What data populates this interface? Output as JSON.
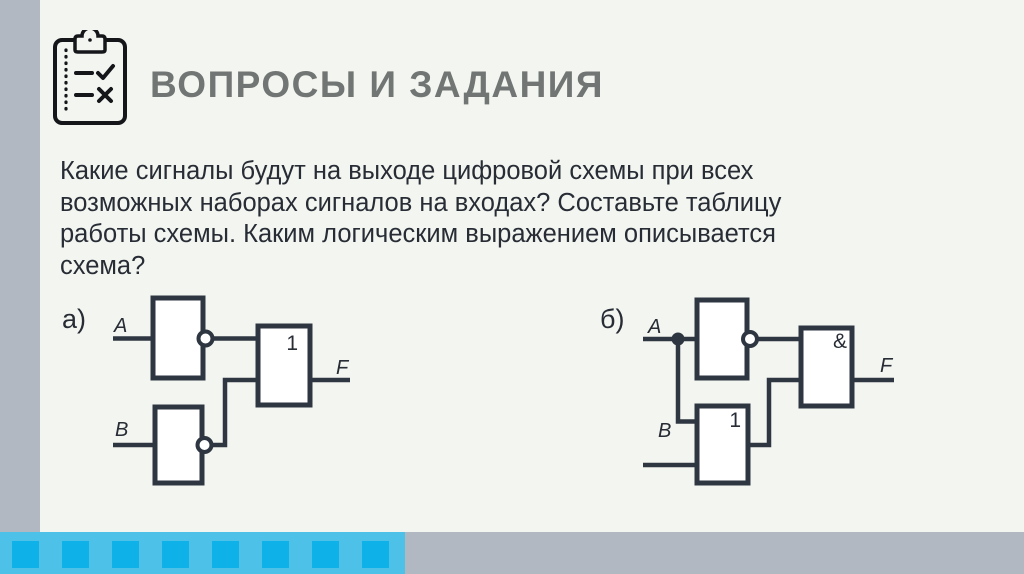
{
  "header": {
    "title": "ВОПРОСЫ И ЗАДАНИЯ",
    "icon": "checklist-clipboard-icon"
  },
  "question": {
    "lines": [
      "Какие сигналы будут на выходе цифровой схемы при всех",
      "возможных наборах сигналов на входах? Составьте таблицу",
      "работы схемы. Каким логическим выражением описывается",
      "схема?"
    ]
  },
  "circuits": {
    "a": {
      "label": "а)",
      "input_a_label": "A",
      "input_b_label": "B",
      "not_gate_top_label": "",
      "not_gate_bottom_label": "",
      "or_gate_label": "1",
      "output_label": "F"
    },
    "b": {
      "label": "б)",
      "input_a_label": "A",
      "input_b_label": "B",
      "not_gate_label": "",
      "or_gate_label": "1",
      "and_gate_label": "&",
      "output_label": "F"
    }
  },
  "colors": {
    "background": "#f3f5f0",
    "accent_bar": "#b2b8c2",
    "strip_cyan": "#4ec1e9",
    "strip_square": "#0eb2e8",
    "circuit_stroke": "#2e3642",
    "title_text": "#717573",
    "body_text": "#272c35"
  }
}
